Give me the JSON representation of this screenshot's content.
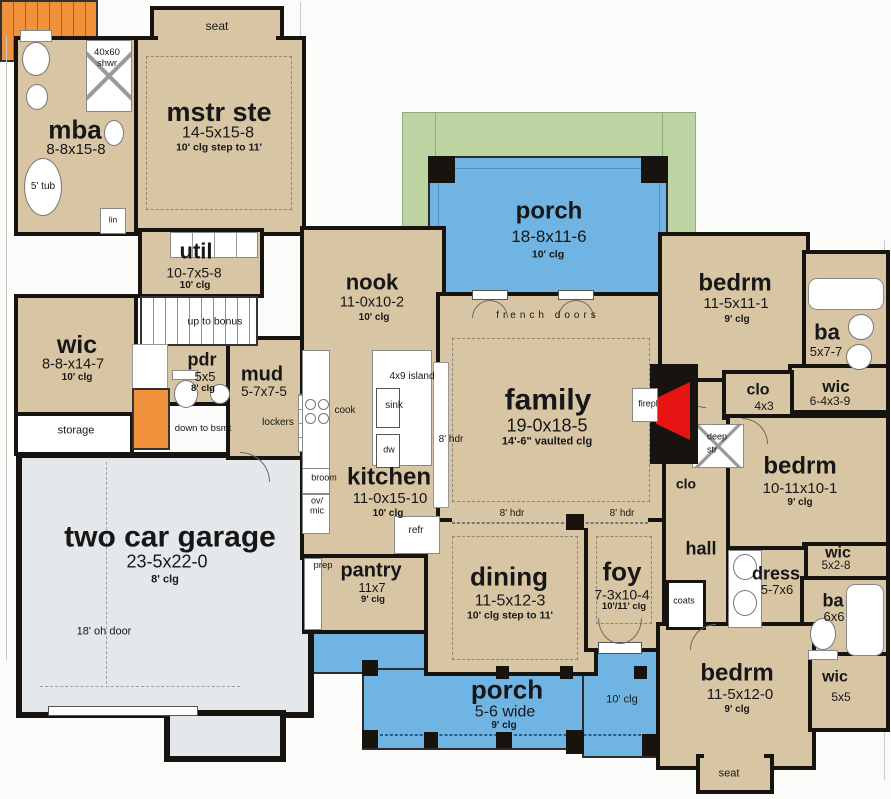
{
  "colors": {
    "room_fill": "#d8c5a3",
    "porch_blue": "#6fb4e2",
    "porch_green": "#bdd5a3",
    "garage_gray": "#e4e8eb",
    "stair_orange": "#f0913c",
    "fireplace_red": "#e81414",
    "wall": "#17130f"
  },
  "rooms": {
    "mstr": {
      "name": "mstr ste",
      "dims": "14-5x15-8",
      "clg": "10' clg step to 11'"
    },
    "mba": {
      "name": "mba",
      "dims": "8-8x15-8"
    },
    "util": {
      "name": "util",
      "dims": "10-7x5-8",
      "clg": "10' clg"
    },
    "wic_master": {
      "name": "wic",
      "dims": "8-8-x14-7",
      "clg": "10' clg"
    },
    "pdr": {
      "name": "pdr",
      "dims": "5x5",
      "clg": "8' clg"
    },
    "mud": {
      "name": "mud",
      "dims": "5-7x7-5"
    },
    "garage": {
      "name": "two car garage",
      "dims": "23-5x22-0",
      "clg": "8' clg"
    },
    "nook": {
      "name": "nook",
      "dims": "11-0x10-2",
      "clg": "10' clg"
    },
    "kitchen": {
      "name": "kitchen",
      "dims": "11-0x15-10",
      "clg": "10' clg"
    },
    "pantry": {
      "name": "pantry",
      "dims": "11x7",
      "clg": "9' clg"
    },
    "porch_top": {
      "name": "porch",
      "dims": "18-8x11-6",
      "clg": "10' clg"
    },
    "family": {
      "name": "family",
      "dims": "19-0x18-5",
      "clg": "14'-6\" vaulted clg"
    },
    "dining": {
      "name": "dining",
      "dims": "11-5x12-3",
      "clg": "10' clg step to 11'"
    },
    "foy": {
      "name": "foy",
      "dims": "7-3x10-4",
      "clg": "10'/11' clg"
    },
    "porch_bottom": {
      "name": "porch",
      "dims": "5-6 wide",
      "clg": "9' clg",
      "clg2": "10' clg"
    },
    "bedrm_ne": {
      "name": "bedrm",
      "dims": "11-5x11-1",
      "clg": "9' clg"
    },
    "ba_ne": {
      "name": "ba",
      "dims": "5x7-7"
    },
    "wic_ne": {
      "name": "wic",
      "dims": "6-4x3-9"
    },
    "clo_ne": {
      "name": "clo",
      "dims": "4x3"
    },
    "bedrm_e": {
      "name": "bedrm",
      "dims": "10-11x10-1",
      "clg": "9' clg"
    },
    "wic_e": {
      "name": "wic",
      "dims": "5x2-8"
    },
    "dress": {
      "name": "dress",
      "dims": "5-7x6"
    },
    "ba_se": {
      "name": "ba",
      "dims": "6x6"
    },
    "bedrm_se": {
      "name": "bedrm",
      "dims": "11-5x12-0",
      "clg": "9' clg"
    },
    "wic_se": {
      "name": "wic",
      "dims": "5x5"
    },
    "hall": {
      "name": "hall"
    },
    "clo_hall": {
      "name": "clo"
    }
  },
  "annotations": {
    "seat_top": "seat",
    "seat_bottom": "seat",
    "shower_size": "40x60",
    "shower": "shwr",
    "tub": "5' tub",
    "lin": "lin",
    "up_to_bonus": "up to bonus",
    "down_to_bsmt": "down to bsmt",
    "storage": "storage",
    "lockers": "lockers",
    "oh_door": "18' oh door",
    "island": "4x9 island",
    "sink": "sink",
    "dw": "dw",
    "cook": "cook",
    "broom": "broom",
    "ov": "ov/",
    "mic": "mic",
    "refr": "refr",
    "prep": "prep",
    "french_doors": "french doors",
    "hdr": "8' hdr",
    "firepl": "firepl",
    "deep_str_1": "deep",
    "deep_str_2": "str",
    "coats": "coats"
  }
}
